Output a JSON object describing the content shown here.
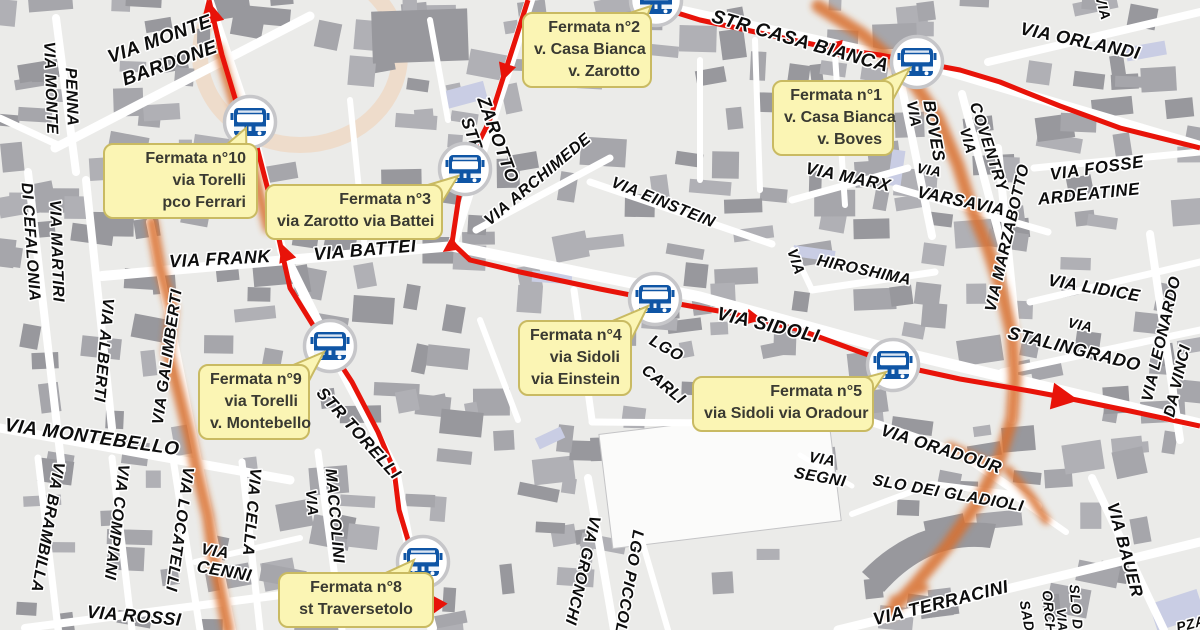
{
  "map_title": "Bus stops map (fermate) – via Sidoli / via Torelli area",
  "colors": {
    "background": "#ebebe9",
    "building": "#a6a6ab",
    "building_dark": "#98989d",
    "building_white": "#fbfbfa",
    "building_lavender": "#c9cde4",
    "road": "#ffffff",
    "route_red": "#e81309",
    "highlight_orange": "#d96f2e",
    "park_ring": "#f0cfb2",
    "callout_bg": "#fbf5b4",
    "callout_border": "#c9ba62",
    "callout_text": "#3a3a32",
    "bus_blue": "#0f55a5",
    "icon_ring": "#c6c6c9",
    "label_text": "#0d0d0d",
    "label_halo": "#ffffff"
  },
  "stops": [
    {
      "name": "fermata-1",
      "lines": [
        "Fermata n°1",
        "v. Casa Bianca",
        "v. Boves"
      ],
      "icon": {
        "x": 917,
        "y": 62
      },
      "box": {
        "x": 772,
        "y": 80,
        "w": 122,
        "h": 74
      },
      "align": "right",
      "tail": [
        [
          856,
          92
        ],
        [
          884,
          116
        ],
        [
          910,
          68
        ]
      ]
    },
    {
      "name": "fermata-2",
      "lines": [
        "Fermata n°2",
        "v. Casa Bianca",
        "v. Zarotto"
      ],
      "icon": {
        "x": 656,
        "y": 0
      },
      "box": {
        "x": 522,
        "y": 12,
        "w": 130,
        "h": 74
      },
      "align": "right",
      "tail": [
        [
          602,
          22
        ],
        [
          636,
          46
        ],
        [
          651,
          6
        ]
      ]
    },
    {
      "name": "fermata-3",
      "lines": [
        "Fermata n°3",
        "via Zarotto via Battei"
      ],
      "icon": {
        "x": 465,
        "y": 169
      },
      "box": {
        "x": 265,
        "y": 184,
        "w": 178,
        "h": 56
      },
      "align": "right",
      "tail": [
        [
          398,
          194
        ],
        [
          430,
          222
        ],
        [
          458,
          176
        ]
      ]
    },
    {
      "name": "fermata-4",
      "lines": [
        "Fermata n°4",
        "via Sidoli",
        "via Einstein"
      ],
      "icon": {
        "x": 655,
        "y": 299
      },
      "box": {
        "x": 518,
        "y": 320,
        "w": 114,
        "h": 74
      },
      "align": "right",
      "tail": [
        [
          596,
          328
        ],
        [
          624,
          354
        ],
        [
          648,
          306
        ]
      ]
    },
    {
      "name": "fermata-5",
      "lines": [
        "Fermata n°5",
        "via Sidoli via Oradour"
      ],
      "icon": {
        "x": 893,
        "y": 365
      },
      "box": {
        "x": 692,
        "y": 376,
        "w": 182,
        "h": 56
      },
      "align": "right",
      "tail": [
        [
          834,
          386
        ],
        [
          862,
          408
        ],
        [
          886,
          372
        ]
      ]
    },
    {
      "name": "fermata-8",
      "lines": [
        "Fermata n°8",
        "st Traversetolo"
      ],
      "icon": {
        "x": 423,
        "y": 562
      },
      "box": {
        "x": 278,
        "y": 572,
        "w": 156,
        "h": 56
      },
      "align": "center",
      "tail": [
        [
          366,
          582
        ],
        [
          396,
          606
        ],
        [
          414,
          560
        ]
      ]
    },
    {
      "name": "fermata-9",
      "lines": [
        "Fermata n°9",
        "via Torelli",
        "v. Montebello"
      ],
      "icon": {
        "x": 330,
        "y": 346
      },
      "box": {
        "x": 198,
        "y": 364,
        "w": 112,
        "h": 74
      },
      "align": "right",
      "tail": [
        [
          272,
          374
        ],
        [
          300,
          398
        ],
        [
          324,
          352
        ]
      ]
    },
    {
      "name": "fermata-10",
      "lines": [
        "Fermata n°10",
        "via Torelli",
        "pco Ferrari"
      ],
      "icon": {
        "x": 250,
        "y": 122
      },
      "box": {
        "x": 103,
        "y": 143,
        "w": 155,
        "h": 74
      },
      "align": "right",
      "tail": [
        [
          218,
          152
        ],
        [
          247,
          178
        ],
        [
          246,
          128
        ]
      ]
    }
  ],
  "street_labels": [
    {
      "text": "VIA MONTE",
      "x": 160,
      "y": 40,
      "rot": -20,
      "size": 19
    },
    {
      "text": "BARDONE",
      "x": 170,
      "y": 64,
      "rot": -20,
      "size": 19
    },
    {
      "text": "VIA MONTE",
      "x": 50,
      "y": 88,
      "rot": 88,
      "size": 16
    },
    {
      "text": "PENNA",
      "x": 71,
      "y": 97,
      "rot": 88,
      "size": 16
    },
    {
      "text": "VIA MARTIRI",
      "x": 56,
      "y": 251,
      "rot": 88,
      "size": 16
    },
    {
      "text": "DI CEFALONIA",
      "x": 30,
      "y": 242,
      "rot": 86,
      "size": 16
    },
    {
      "text": "VIA ALBERTI",
      "x": 103,
      "y": 350,
      "rot": 95,
      "size": 16
    },
    {
      "text": "VIA GALIMBERTI",
      "x": 168,
      "y": 357,
      "rot": -82,
      "size": 16
    },
    {
      "text": "VIA MONTEBELLO",
      "x": 92,
      "y": 438,
      "rot": 8,
      "size": 19
    },
    {
      "text": "VIA BRAMBILLA",
      "x": 47,
      "y": 527,
      "rot": 100,
      "size": 16
    },
    {
      "text": "VIA COMPIANI",
      "x": 116,
      "y": 522,
      "rot": 97,
      "size": 16
    },
    {
      "text": "VIA LOCATELLI",
      "x": 179,
      "y": 529,
      "rot": 98,
      "size": 16
    },
    {
      "text": "VIA CELLA",
      "x": 251,
      "y": 512,
      "rot": 95,
      "size": 16
    },
    {
      "text": "VIA",
      "x": 215,
      "y": 552,
      "rot": 10,
      "size": 16
    },
    {
      "text": "CENNI",
      "x": 224,
      "y": 572,
      "rot": 10,
      "size": 17
    },
    {
      "text": "VIA ROSSI",
      "x": 134,
      "y": 617,
      "rot": 5,
      "size": 18
    },
    {
      "text": "VIA",
      "x": 311,
      "y": 503,
      "rot": 85,
      "size": 15
    },
    {
      "text": "MACCOLINI",
      "x": 334,
      "y": 516,
      "rot": 85,
      "size": 16
    },
    {
      "text": "STR TORELLI",
      "x": 358,
      "y": 434,
      "rot": 48,
      "size": 17
    },
    {
      "text": "VIA FRANK",
      "x": 220,
      "y": 260,
      "rot": -3,
      "size": 18
    },
    {
      "text": "VIA BATTEI",
      "x": 365,
      "y": 251,
      "rot": -5,
      "size": 18
    },
    {
      "text": "STR",
      "x": 471,
      "y": 135,
      "rot": 70,
      "size": 17
    },
    {
      "text": "ZAROTTO",
      "x": 497,
      "y": 140,
      "rot": 70,
      "size": 18
    },
    {
      "text": "VIA ARCHIMEDE",
      "x": 538,
      "y": 180,
      "rot": -40,
      "size": 16
    },
    {
      "text": "VIA EINSTEIN",
      "x": 663,
      "y": 203,
      "rot": 22,
      "size": 16
    },
    {
      "text": "STR CASA BIANCA",
      "x": 800,
      "y": 42,
      "rot": 16,
      "size": 19
    },
    {
      "text": "VIA ORLANDI",
      "x": 1080,
      "y": 42,
      "rot": 12,
      "size": 18
    },
    {
      "text": "VIA",
      "x": 1102,
      "y": 8,
      "rot": 75,
      "size": 14
    },
    {
      "text": "VIA",
      "x": 913,
      "y": 114,
      "rot": 80,
      "size": 15
    },
    {
      "text": "BOVES",
      "x": 933,
      "y": 131,
      "rot": 80,
      "size": 17
    },
    {
      "text": "VIA",
      "x": 967,
      "y": 141,
      "rot": 75,
      "size": 15
    },
    {
      "text": "COVENTRY",
      "x": 988,
      "y": 147,
      "rot": 72,
      "size": 16
    },
    {
      "text": "VIA",
      "x": 929,
      "y": 171,
      "rot": 10,
      "size": 14
    },
    {
      "text": "VARSAVIA",
      "x": 961,
      "y": 202,
      "rot": 12,
      "size": 17
    },
    {
      "text": "VIA MARX",
      "x": 848,
      "y": 178,
      "rot": 12,
      "size": 17
    },
    {
      "text": "VIA FOSSE",
      "x": 1097,
      "y": 169,
      "rot": -8,
      "size": 17
    },
    {
      "text": "ARDEATINE",
      "x": 1089,
      "y": 195,
      "rot": -6,
      "size": 17
    },
    {
      "text": "VIA MARZABOTTO",
      "x": 1008,
      "y": 238,
      "rot": -77,
      "size": 16
    },
    {
      "text": "VIA",
      "x": 795,
      "y": 262,
      "rot": 72,
      "size": 15
    },
    {
      "text": "HIROSHIMA",
      "x": 864,
      "y": 271,
      "rot": 12,
      "size": 16
    },
    {
      "text": "VIA SIDOLI",
      "x": 768,
      "y": 326,
      "rot": 13,
      "size": 19
    },
    {
      "text": "LGO",
      "x": 666,
      "y": 349,
      "rot": 30,
      "size": 16
    },
    {
      "text": "CARLI",
      "x": 663,
      "y": 385,
      "rot": 40,
      "size": 16
    },
    {
      "text": "VIA LIDICE",
      "x": 1094,
      "y": 289,
      "rot": 10,
      "size": 17
    },
    {
      "text": "VIA",
      "x": 1080,
      "y": 326,
      "rot": 12,
      "size": 14
    },
    {
      "text": "STALINGRADO",
      "x": 1074,
      "y": 350,
      "rot": 14,
      "size": 18
    },
    {
      "text": "VIA LEONARDO",
      "x": 1162,
      "y": 339,
      "rot": -77,
      "size": 16
    },
    {
      "text": "DA VINCI",
      "x": 1178,
      "y": 381,
      "rot": -77,
      "size": 16
    },
    {
      "text": "VIA",
      "x": 822,
      "y": 460,
      "rot": 10,
      "size": 15
    },
    {
      "text": "SEGNI",
      "x": 820,
      "y": 478,
      "rot": 10,
      "size": 16
    },
    {
      "text": "VIA ORADOUR",
      "x": 941,
      "y": 450,
      "rot": 18,
      "size": 17
    },
    {
      "text": "SLO DEI GLADIOLI",
      "x": 948,
      "y": 494,
      "rot": 10,
      "size": 16
    },
    {
      "text": "VIA TERRACINI",
      "x": 941,
      "y": 604,
      "rot": -14,
      "size": 18
    },
    {
      "text": "VIA BAUER",
      "x": 1124,
      "y": 550,
      "rot": 75,
      "size": 17
    },
    {
      "text": "VIA GRONCHI",
      "x": 582,
      "y": 570,
      "rot": 103,
      "size": 16
    },
    {
      "text": "LGO PICCOLI",
      "x": 628,
      "y": 584,
      "rot": 100,
      "size": 16
    },
    {
      "text": "SAD",
      "x": 1026,
      "y": 616,
      "rot": 80,
      "size": 14
    },
    {
      "text": "ORCH",
      "x": 1048,
      "y": 612,
      "rot": 85,
      "size": 14
    },
    {
      "text": "VIA",
      "x": 1061,
      "y": 620,
      "rot": 85,
      "size": 13
    },
    {
      "text": "SLO D",
      "x": 1075,
      "y": 607,
      "rot": 85,
      "size": 14
    },
    {
      "text": "PZA",
      "x": 1191,
      "y": 625,
      "rot": -15,
      "size": 14
    }
  ],
  "route": {
    "paths": [
      [
        [
          209,
          0
        ],
        [
          222,
          55
        ],
        [
          238,
          108
        ],
        [
          252,
          128
        ],
        [
          268,
          190
        ],
        [
          281,
          248
        ],
        [
          290,
          288
        ],
        [
          316,
          330
        ],
        [
          330,
          348
        ],
        [
          352,
          382
        ],
        [
          378,
          432
        ],
        [
          394,
          470
        ],
        [
          399,
          510
        ],
        [
          408,
          540
        ],
        [
          422,
          562
        ],
        [
          430,
          590
        ],
        [
          426,
          618
        ]
      ],
      [
        [
          528,
          0
        ],
        [
          516,
          38
        ],
        [
          505,
          72
        ],
        [
          489,
          122
        ],
        [
          468,
          163
        ],
        [
          459,
          196
        ],
        [
          452,
          243
        ],
        [
          470,
          260
        ],
        [
          520,
          272
        ],
        [
          600,
          289
        ],
        [
          656,
          300
        ],
        [
          730,
          313
        ],
        [
          800,
          330
        ],
        [
          860,
          352
        ],
        [
          900,
          366
        ],
        [
          960,
          379
        ],
        [
          1030,
          391
        ],
        [
          1062,
          397
        ],
        [
          1130,
          411
        ],
        [
          1200,
          426
        ]
      ],
      [
        [
          642,
          2
        ],
        [
          700,
          20
        ],
        [
          760,
          33
        ],
        [
          830,
          48
        ],
        [
          880,
          55
        ],
        [
          917,
          62
        ],
        [
          960,
          70
        ],
        [
          1000,
          82
        ],
        [
          1060,
          106
        ],
        [
          1120,
          128
        ],
        [
          1200,
          148
        ]
      ]
    ],
    "arrows": [
      {
        "x": 210,
        "y": 12,
        "rot": -103,
        "s": 24
      },
      {
        "x": 285,
        "y": 253,
        "rot": -110,
        "s": 18
      },
      {
        "x": 505,
        "y": 72,
        "rot": 108,
        "s": 18
      },
      {
        "x": 450,
        "y": 247,
        "rot": 145,
        "s": 16
      },
      {
        "x": 833,
        "y": 47,
        "rot": -168,
        "s": 18
      },
      {
        "x": 754,
        "y": 318,
        "rot": 11,
        "s": 16
      },
      {
        "x": 1064,
        "y": 398,
        "rot": 9,
        "s": 27
      },
      {
        "x": 430,
        "y": 608,
        "rot": 118,
        "s": 27
      }
    ]
  }
}
